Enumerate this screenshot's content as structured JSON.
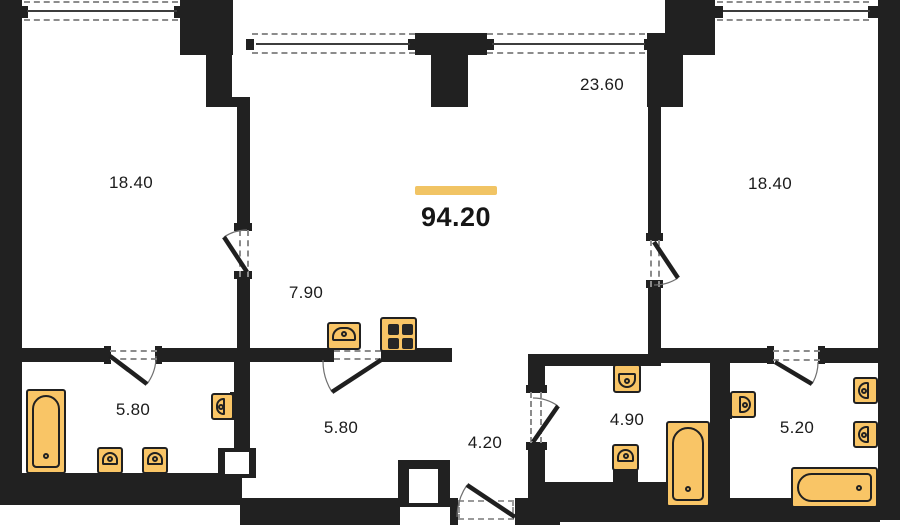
{
  "floorplan": {
    "total": {
      "value": "94.20"
    },
    "labels": {
      "room_left": "18.40",
      "living": "23.60",
      "room_right": "18.40",
      "kitchen": "7.90",
      "bath_left": "5.80",
      "storage": "5.80",
      "hall": "4.20",
      "bath_mid": "4.90",
      "bath_right": "5.20"
    },
    "colors": {
      "wall": "#212121",
      "fixture_fill": "#f9c566",
      "accent_bar": "#f1c464",
      "dashed_line": "#8c8c8c",
      "text": "#1b1b1b",
      "background": "#ffffff"
    }
  }
}
